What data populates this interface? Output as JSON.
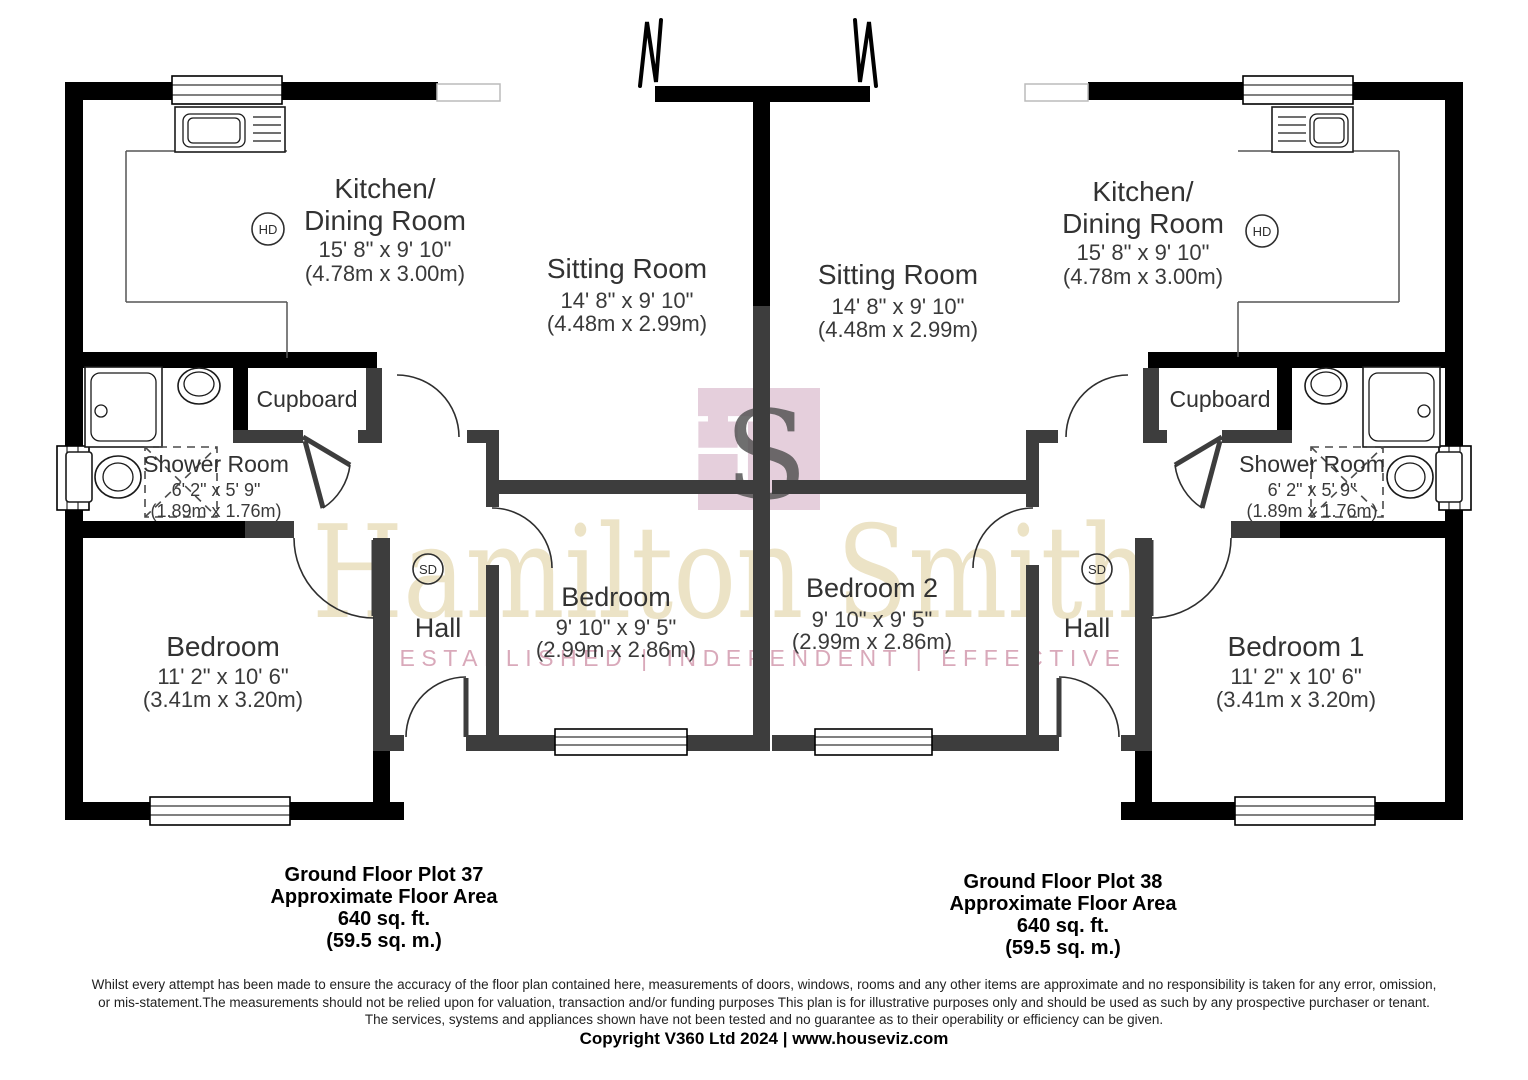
{
  "watermark": {
    "brand": "Hamilton Smith",
    "tagline": "ESTABLISHED | INDEPENDENT | EFFECTIVE",
    "logo_letter_h": "H",
    "logo_letter_s": "S",
    "brand_color": "#ece3c6",
    "tagline_color": "#d9a9ba",
    "logo_color": "#e5cfdc"
  },
  "colors": {
    "wall_black": "#000000",
    "wall_gray": "#3d3d3d"
  },
  "plot37": {
    "kitchen_name_line1": "Kitchen/",
    "kitchen_name_line2": "Dining Room",
    "kitchen_dims": "15' 8\" x 9' 10\"",
    "kitchen_metric": "(4.78m x 3.00m)",
    "sitting_name": "Sitting Room",
    "sitting_dims": "14' 8\" x 9' 10\"",
    "sitting_metric": "(4.48m x 2.99m)",
    "cupboard": "Cupboard",
    "shower_name": "Shower Room",
    "shower_dims": "6' 2\" x 5' 9\"",
    "shower_metric": "(1.89m x 1.76m)",
    "bedroom_name": "Bedroom",
    "bedroom_dims": "11' 2\" x 10' 6\"",
    "bedroom_metric": "(3.41m x 3.20m)",
    "midbedroom_name": "Bedroom",
    "midbedroom_dims": "9' 10\" x 9' 5\"",
    "midbedroom_metric": "(2.99m x 2.86m)",
    "hall": "Hall",
    "caption_line1": "Ground Floor Plot 37",
    "caption_line2": "Approximate Floor Area",
    "caption_line3": "640 sq. ft.",
    "caption_line4": "(59.5 sq. m.)"
  },
  "plot38": {
    "kitchen_name_line1": "Kitchen/",
    "kitchen_name_line2": "Dining Room",
    "kitchen_dims": "15' 8\" x 9' 10\"",
    "kitchen_metric": "(4.78m x 3.00m)",
    "sitting_name": "Sitting Room",
    "sitting_dims": "14' 8\" x 9' 10\"",
    "sitting_metric": "(4.48m x 2.99m)",
    "cupboard": "Cupboard",
    "shower_name": "Shower Room",
    "shower_dims": "6' 2\" x 5' 9\"",
    "shower_metric": "(1.89m x 1.76m)",
    "bedroom_name": "Bedroom 1",
    "bedroom_dims": "11' 2\" x 10' 6\"",
    "bedroom_metric": "(3.41m x 3.20m)",
    "midbedroom_name": "Bedroom 2",
    "midbedroom_dims": "9' 10\" x 9' 5\"",
    "midbedroom_metric": "(2.99m x 2.86m)",
    "hall": "Hall",
    "caption_line1": "Ground Floor Plot 38",
    "caption_line2": "Approximate Floor Area",
    "caption_line3": "640 sq. ft.",
    "caption_line4": "(59.5 sq. m.)"
  },
  "detectors": {
    "heat": "HD",
    "smoke": "SD"
  },
  "footer": {
    "disclaimer_line1": "Whilst every attempt has been made to ensure the accuracy of the floor plan contained here, measurements of doors, windows, rooms and any other items are approximate and no responsibility is taken for any error, omission,",
    "disclaimer_line2": "or mis-statement.The measurements should not be relied upon for valuation, transaction and/or funding purposes This plan is for illustrative purposes only and should be used as such by any prospective purchaser or tenant.",
    "disclaimer_line3": "The services, systems and appliances shown have not been tested and no guarantee as to their operability or efficiency can be given.",
    "copyright": "Copyright V360 Ltd 2024 | www.houseviz.com"
  }
}
